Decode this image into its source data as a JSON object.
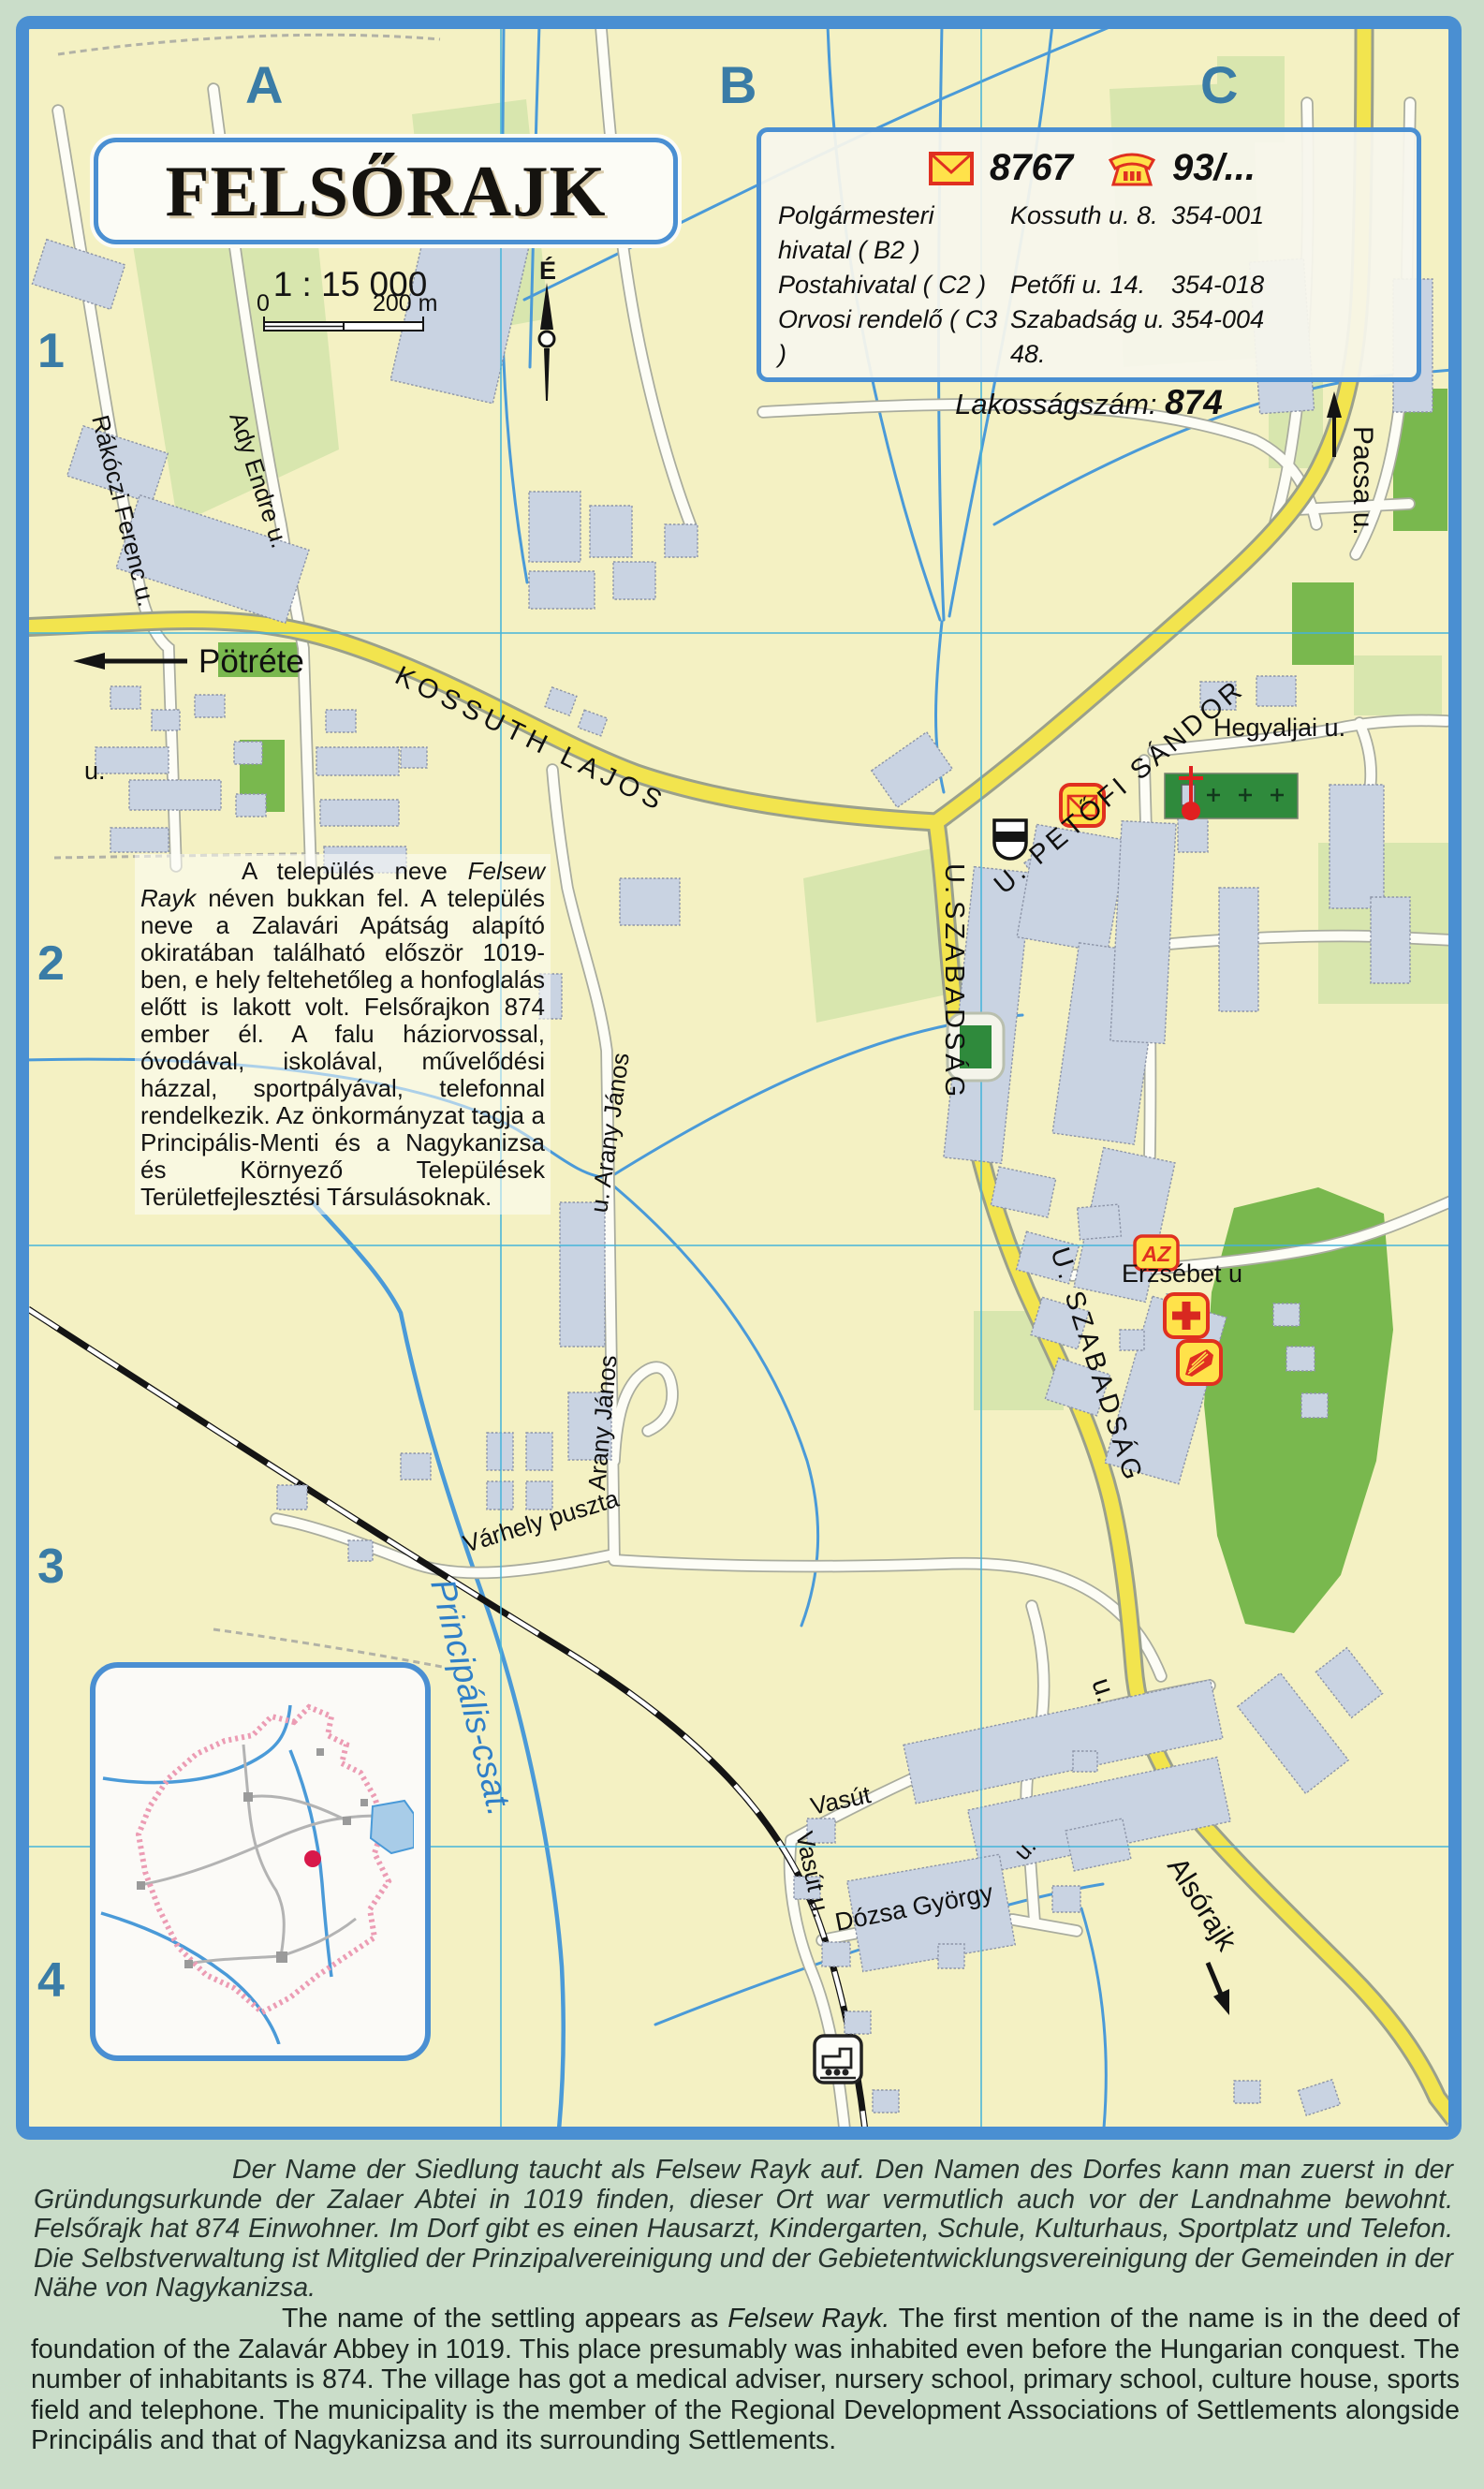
{
  "map": {
    "title": "FELSŐRAJK",
    "scale_ratio": "1 : 15 000",
    "scale_zero": "0",
    "scale_end": "200 m",
    "north_label": "É",
    "grid_columns": [
      "A",
      "B",
      "C"
    ],
    "grid_rows": [
      "1",
      "2",
      "3",
      "4"
    ],
    "streets": [
      "KOSSUTH LAJOS",
      "U.",
      "SZABADSÁG",
      "U.  SZABADSÁG",
      "U. PETŐFI SÁNDOR",
      "Rákóczi Ferenc u.",
      "Ady Endre u.",
      "Hegyaljai u.",
      "Erzsébet u",
      "Pacsa u.",
      "u. Arany János",
      "Arany János",
      "Várhely puszta",
      "Vasút",
      "Vasút u.",
      "Dózsa György",
      "u.",
      "u.",
      "u.",
      "Principális-csat."
    ],
    "directions": {
      "west": "Pötréte",
      "southeast": "Alsórajk"
    },
    "shop_icon_text": "AZ"
  },
  "info_box": {
    "postal_code": "8767",
    "phone_prefix": "93/...",
    "rows": [
      {
        "name": "Polgármesteri hivatal ( B2 )",
        "address": "Kossuth u. 8.",
        "phone": "354-001"
      },
      {
        "name": "Postahivatal ( C2 )",
        "address": "Petőfi u. 14.",
        "phone": "354-018"
      },
      {
        "name": "Orvosi rendelő ( C3 )",
        "address": "Szabadság u. 48.",
        "phone": "354-004"
      }
    ],
    "population_label": "Lakosságszám:",
    "population_value": "874"
  },
  "description_hu": {
    "part1": "A település neve ",
    "italic": "Felsew Rayk",
    "part2": " néven bukkan fel. A település neve a Zalavári Apátság alapító okiratában található először 1019-ben, e hely feltehetőleg a honfoglalás előtt is lakott volt. Felsőrajkon 874 ember él. A falu háziorvossal, óvodával, iskolával, művelődési házzal, sportpályával, telefonnal rendelkezik. Az önkormányzat tagja a Principális-Menti és a Nagykanizsa és Környező Települések Területfejlesztési Társulásoknak."
  },
  "paragraph_de": "Der Name  der Siedlung taucht als Felsew Rayk auf. Den Namen des Dorfes kann man zuerst in der Gründungsurkunde der Zalaer Abtei in 1019 finden, dieser Ort war vermutlich auch vor der Landnahme bewohnt. Felsőrajk hat 874 Einwohner. Im Dorf gibt es einen Hausarzt, Kindergarten, Schule, Kulturhaus,  Sportplatz und Telefon. Die Selbstverwaltung ist Mitglied der Prinzipalvereinigung und der Gebietentwicklungsvereinigung der Gemeinden in der Nähe von Nagykanizsa.",
  "paragraph_en": {
    "part1": "The name of the settling appears as ",
    "italic": "Felsew Rayk.",
    "part2": " The first mention of the name is in the deed of foundation of the Zalavár Abbey in 1019. This place presumably was inhabited even before the Hungarian conquest. The number of inhabitants is 874. The village has got a medical adviser, nursery school, primary school, culture house, sports field and telephone. The municipality is the member of the Regional Development Associations of Settlements alongside Principális and that of Nagykanizsa and its surrounding Settlements."
  },
  "colors": {
    "map_border": "#4a8fd2",
    "main_road": "#f2e44e",
    "water": "#4a9ad8",
    "forest": "#79b84e",
    "building": "#c9d3e2",
    "grid_label": "#3a7ca6",
    "icon_yellow": "#ffe24a",
    "icon_red": "#e03020",
    "canal_label": "#2f7fc8"
  }
}
